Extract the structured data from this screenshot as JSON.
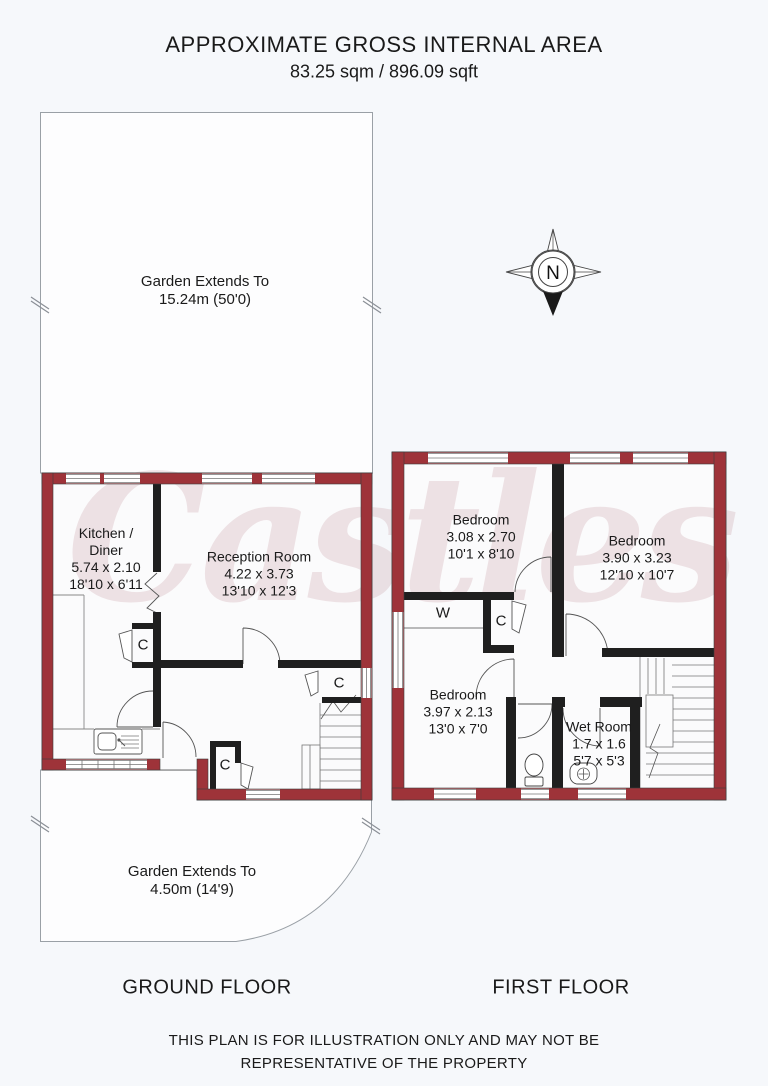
{
  "title": {
    "line1": "APPROXIMATE GROSS INTERNAL AREA",
    "line2": "83.25 sqm / 896.09 sqft"
  },
  "watermark": "Castles",
  "compass": {
    "label": "N"
  },
  "garden_top": {
    "line1": "Garden Extends To",
    "line2": "15.24m (50'0)"
  },
  "garden_bottom": {
    "line1": "Garden Extends To",
    "line2": "4.50m (14'9)"
  },
  "ground_floor": {
    "label": "GROUND FLOOR",
    "kitchen": {
      "name_line1": "Kitchen /",
      "name_line2": "Diner",
      "metric": "5.74 x 2.10",
      "imperial": "18'10 x 6'11"
    },
    "reception": {
      "name": "Reception Room",
      "metric": "4.22 x 3.73",
      "imperial": "13'10 x 12'3"
    },
    "closet_kitchen": "C",
    "closet_stairs": "C",
    "closet_hall": "C"
  },
  "first_floor": {
    "label": "FIRST FLOOR",
    "bedroom1": {
      "name": "Bedroom",
      "metric": "3.08 x 2.70",
      "imperial": "10'1 x 8'10"
    },
    "bedroom2": {
      "name": "Bedroom",
      "metric": "3.90 x 3.23",
      "imperial": "12'10 x 10'7"
    },
    "bedroom3": {
      "name": "Bedroom",
      "metric": "3.97 x 2.13",
      "imperial": "13'0 x 7'0"
    },
    "wet_room": {
      "name": "Wet Room",
      "metric": "1.7 x 1.6",
      "imperial": "5'7 x 5'3"
    },
    "wardrobe": "W",
    "closet": "C"
  },
  "footer": {
    "line1": "THIS PLAN IS FOR ILLUSTRATION ONLY AND MAY NOT BE",
    "line2": "REPRESENTATIVE OF THE PROPERTY"
  },
  "colors": {
    "wall_fill": "#9e3339",
    "interior_wall": "#1f1f1f",
    "garden_outline": "#9aa0a6",
    "background": "#f6f8fb",
    "watermark": "#b97f85",
    "text": "#1a1a1a"
  }
}
